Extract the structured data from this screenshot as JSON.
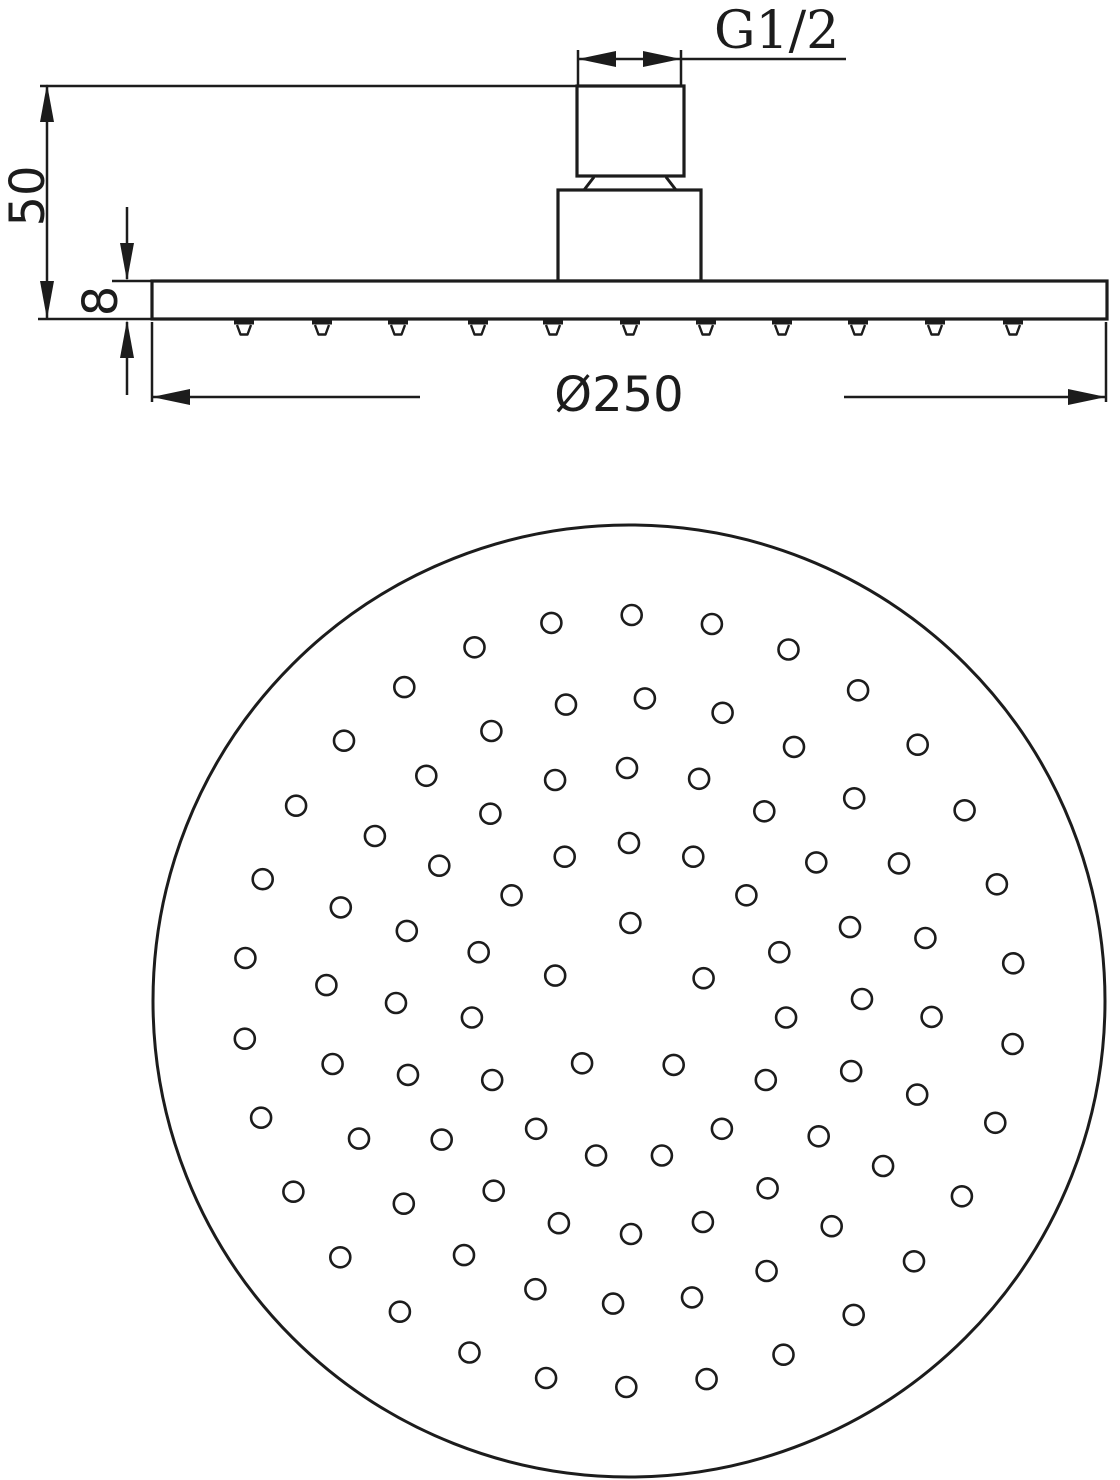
{
  "labels": {
    "thread_size": "G1/2",
    "overall_height": "50",
    "plate_thickness": "8",
    "diameter": "Ø250"
  },
  "colors": {
    "line": "#1c1c1c",
    "background": "#ffffff"
  },
  "chart_data": {
    "type": "technical-drawing",
    "subject": "overhead rain shower head, side elevation and spray face view",
    "views": [
      {
        "name": "side-elevation",
        "plate": {
          "x": 152,
          "y": 281,
          "width": 955,
          "height": 38
        },
        "body": {
          "x": 558,
          "y": 190,
          "width": 143,
          "height": 91
        },
        "nipple": {
          "x": 577,
          "y": 86,
          "width": 107,
          "height": 90
        },
        "nozzle_x_positions": [
          244,
          322,
          398,
          478,
          553,
          630,
          706,
          782,
          858,
          935,
          1013
        ],
        "nozzle_top_y": 322,
        "nozzle_tip_y": 334.5,
        "dimension_labels": [
          "G1/2",
          "50",
          "8",
          "Ø250"
        ]
      },
      {
        "name": "spray-face-view",
        "face_circle": {
          "cx": 629,
          "cy": 1001,
          "r": 476
        },
        "hole_radius": 10,
        "hole_rings": [
          {
            "ring_radius": 78,
            "hole_count": 5,
            "start_angle_deg": 17
          },
          {
            "ring_radius": 158,
            "hole_count": 15,
            "start_angle_deg": 18
          },
          {
            "ring_radius": 233,
            "hole_count": 20,
            "start_angle_deg": 0.5
          },
          {
            "ring_radius": 303,
            "hole_count": 24,
            "start_angle_deg": 12
          },
          {
            "ring_radius": 386,
            "hole_count": 30,
            "start_angle_deg": 5.6
          }
        ],
        "total_holes": 94
      }
    ]
  }
}
